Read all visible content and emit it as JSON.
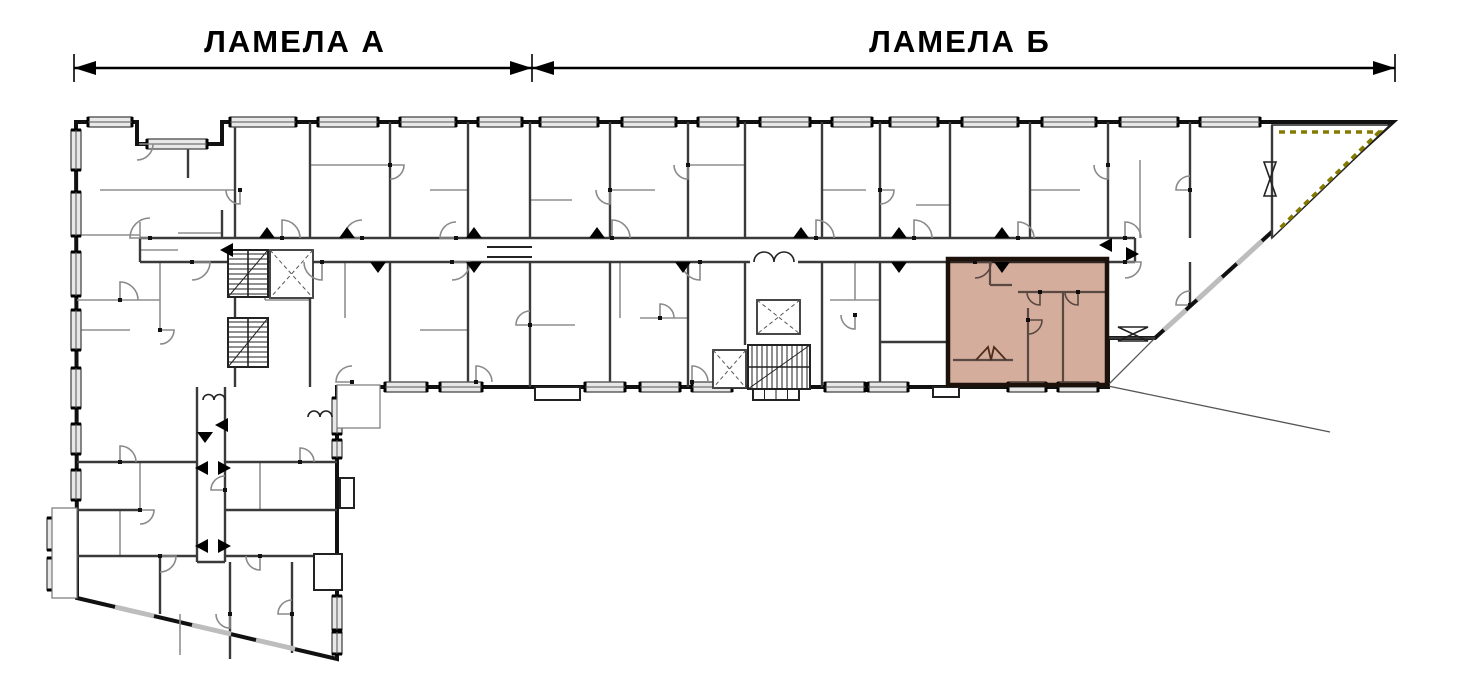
{
  "labels": {
    "lamela_a": "ЛАМЕЛА А",
    "lamela_b": "ЛАМЕЛА  Б"
  },
  "colors": {
    "outline": "#111111",
    "wall_medium": "#3a3a3a",
    "wall_thin": "#8f8f8f",
    "arc": "#8a8a8a",
    "window_fill": "#e8e8e8",
    "window_edge": "#555555",
    "highlight_fill": "#cohere",
    "highlight": "#b97a5e",
    "highlight_border": "#1c120b",
    "terrace_dash": "#857a00",
    "stair": "#222222",
    "canopy": "#555555",
    "apartment_wall": "#6b6b6b",
    "background": "#ffffff"
  },
  "dimension": {
    "y": 68,
    "tick_half": 14,
    "ticks": [
      74,
      532,
      1395
    ],
    "segments": [
      {
        "x1": 74,
        "x2": 532,
        "label_key": "lamela_a",
        "label_x": 295
      },
      {
        "x1": 532,
        "x2": 1395,
        "label_key": "lamela_b",
        "label_x": 960
      }
    ],
    "label_y": 52
  },
  "plan": {
    "outline": [
      [
        76,
        122
      ],
      [
        137,
        122
      ],
      [
        137,
        144
      ],
      [
        222,
        144
      ],
      [
        222,
        122
      ],
      [
        1393,
        122
      ],
      [
        1155,
        338
      ],
      [
        1108,
        338
      ],
      [
        1108,
        387
      ],
      [
        337,
        387
      ],
      [
        337,
        659
      ],
      [
        77,
        598
      ]
    ],
    "canopy_lines": [
      [
        1155,
        338,
        1108,
        385
      ],
      [
        1108,
        386,
        1330,
        432
      ]
    ],
    "corridor_walls": [
      [
        140,
        238,
        1135,
        238
      ],
      [
        140,
        262,
        750,
        262
      ],
      [
        798,
        262,
        1135,
        262
      ],
      [
        140,
        238,
        140,
        262
      ],
      [
        1135,
        238,
        1135,
        262
      ]
    ],
    "walls_medium": [
      [
        235,
        122,
        235,
        238
      ],
      [
        310,
        122,
        310,
        238
      ],
      [
        390,
        122,
        390,
        238
      ],
      [
        468,
        122,
        468,
        238
      ],
      [
        530,
        122,
        530,
        238
      ],
      [
        610,
        122,
        610,
        238
      ],
      [
        688,
        122,
        688,
        238
      ],
      [
        745,
        122,
        745,
        238
      ],
      [
        822,
        122,
        822,
        238
      ],
      [
        880,
        122,
        880,
        238
      ],
      [
        950,
        122,
        950,
        238
      ],
      [
        1030,
        122,
        1030,
        238
      ],
      [
        1108,
        122,
        1108,
        238
      ],
      [
        1190,
        122,
        1190,
        238
      ],
      [
        222,
        210,
        222,
        238
      ],
      [
        188,
        144,
        188,
        178
      ],
      [
        235,
        262,
        235,
        387
      ],
      [
        310,
        262,
        310,
        387
      ],
      [
        390,
        262,
        390,
        387
      ],
      [
        468,
        262,
        468,
        387
      ],
      [
        530,
        262,
        530,
        387
      ],
      [
        610,
        262,
        610,
        387
      ],
      [
        688,
        262,
        688,
        387
      ],
      [
        745,
        262,
        745,
        345
      ],
      [
        822,
        262,
        822,
        387
      ],
      [
        880,
        262,
        880,
        387
      ],
      [
        1190,
        262,
        1190,
        305
      ],
      [
        1108,
        338,
        1155,
        338
      ],
      [
        880,
        342,
        948,
        342
      ],
      [
        1272,
        125,
        1272,
        238
      ],
      [
        197,
        387,
        197,
        562
      ],
      [
        225,
        387,
        225,
        562
      ],
      [
        197,
        562,
        225,
        562
      ],
      [
        77,
        462,
        197,
        462
      ],
      [
        225,
        462,
        337,
        462
      ],
      [
        77,
        510,
        140,
        510
      ],
      [
        225,
        510,
        337,
        510
      ],
      [
        77,
        556,
        197,
        556
      ],
      [
        225,
        556,
        337,
        556
      ],
      [
        230,
        562,
        230,
        659
      ],
      [
        292,
        562,
        292,
        653
      ],
      [
        160,
        556,
        160,
        614
      ]
    ],
    "walls_thin": [
      [
        100,
        190,
        235,
        190
      ],
      [
        310,
        165,
        390,
        165
      ],
      [
        430,
        190,
        468,
        190
      ],
      [
        530,
        200,
        572,
        200
      ],
      [
        610,
        190,
        655,
        190
      ],
      [
        688,
        165,
        745,
        165
      ],
      [
        822,
        190,
        866,
        190
      ],
      [
        916,
        205,
        950,
        205
      ],
      [
        1030,
        190,
        1080,
        190
      ],
      [
        1140,
        160,
        1140,
        238
      ],
      [
        77,
        235,
        140,
        235
      ],
      [
        140,
        222,
        140,
        250
      ],
      [
        140,
        250,
        178,
        250
      ],
      [
        178,
        233,
        222,
        233
      ],
      [
        265,
        300,
        310,
        300
      ],
      [
        265,
        262,
        265,
        300
      ],
      [
        345,
        262,
        345,
        318
      ],
      [
        420,
        330,
        468,
        330
      ],
      [
        530,
        325,
        575,
        325
      ],
      [
        620,
        262,
        620,
        318
      ],
      [
        640,
        318,
        688,
        318
      ],
      [
        830,
        300,
        880,
        300
      ],
      [
        855,
        262,
        855,
        300
      ],
      [
        140,
        462,
        140,
        510
      ],
      [
        260,
        462,
        260,
        510
      ],
      [
        120,
        510,
        120,
        556
      ],
      [
        180,
        614,
        180,
        655
      ],
      [
        77,
        300,
        160,
        300
      ],
      [
        160,
        262,
        160,
        300
      ],
      [
        160,
        300,
        160,
        330
      ],
      [
        77,
        330,
        130,
        330
      ]
    ],
    "walls_apartment": [
      [
        1018,
        292,
        1105,
        292
      ],
      [
        1063,
        292,
        1063,
        383
      ],
      [
        1028,
        308,
        1028,
        383
      ],
      [
        990,
        262,
        990,
        285
      ],
      [
        990,
        285,
        1012,
        285
      ],
      [
        953,
        360,
        1013,
        360
      ]
    ],
    "windows": [
      [
        88,
        117,
        44,
        10
      ],
      [
        147,
        139,
        60,
        10
      ],
      [
        230,
        117,
        66,
        10
      ],
      [
        318,
        117,
        60,
        10
      ],
      [
        400,
        117,
        56,
        10
      ],
      [
        478,
        117,
        44,
        10
      ],
      [
        540,
        117,
        58,
        10
      ],
      [
        622,
        117,
        54,
        10
      ],
      [
        698,
        117,
        40,
        10
      ],
      [
        760,
        117,
        50,
        10
      ],
      [
        832,
        117,
        40,
        10
      ],
      [
        890,
        117,
        48,
        10
      ],
      [
        962,
        117,
        56,
        10
      ],
      [
        1042,
        117,
        54,
        10
      ],
      [
        1120,
        117,
        58,
        10
      ],
      [
        1200,
        117,
        60,
        10
      ],
      [
        71,
        130,
        10,
        40
      ],
      [
        71,
        192,
        10,
        44
      ],
      [
        71,
        252,
        10,
        44
      ],
      [
        71,
        310,
        10,
        40
      ],
      [
        71,
        368,
        10,
        40
      ],
      [
        71,
        424,
        10,
        30
      ],
      [
        71,
        470,
        10,
        30
      ],
      [
        47,
        518,
        10,
        32
      ],
      [
        47,
        558,
        10,
        32
      ],
      [
        385,
        382,
        42,
        10
      ],
      [
        440,
        382,
        42,
        10
      ],
      [
        585,
        382,
        40,
        10
      ],
      [
        640,
        382,
        40,
        10
      ],
      [
        692,
        382,
        40,
        10
      ],
      [
        825,
        382,
        40,
        10
      ],
      [
        868,
        382,
        40,
        10
      ],
      [
        1008,
        382,
        38,
        10
      ],
      [
        1058,
        382,
        40,
        10
      ],
      [
        332,
        398,
        10,
        36
      ],
      [
        332,
        440,
        10,
        18
      ],
      [
        332,
        596,
        10,
        34
      ],
      [
        332,
        632,
        10,
        22
      ]
    ],
    "window_dashes": [
      [
        1262,
        241,
        1237,
        264
      ],
      [
        1222,
        277,
        1197,
        300
      ],
      [
        1186,
        310,
        1164,
        330
      ],
      [
        115,
        607,
        154,
        616
      ],
      [
        192,
        625,
        231,
        634
      ],
      [
        256,
        640,
        295,
        649
      ]
    ],
    "porches": [
      {
        "x": 337,
        "y": 385,
        "w": 43,
        "h": 43,
        "thin": true
      },
      {
        "x": 535,
        "y": 387,
        "w": 45,
        "h": 13,
        "thin": false
      },
      {
        "x": 753,
        "y": 387,
        "w": 46,
        "h": 13,
        "thin": false,
        "steps": true
      },
      {
        "x": 933,
        "y": 387,
        "w": 26,
        "h": 10,
        "thin": false
      },
      {
        "x": 340,
        "y": 478,
        "w": 14,
        "h": 30,
        "thin": false
      },
      {
        "x": 314,
        "y": 554,
        "w": 28,
        "h": 36,
        "thin": false
      },
      {
        "x": 52,
        "y": 508,
        "w": 25,
        "h": 90,
        "thin": true
      }
    ],
    "stairs": [
      {
        "x": 748,
        "y": 345,
        "w": 62,
        "h": 44,
        "dir": "h"
      },
      {
        "x": 228,
        "y": 250,
        "w": 40,
        "h": 47,
        "dir": "v"
      },
      {
        "x": 228,
        "y": 318,
        "w": 40,
        "h": 49,
        "dir": "v"
      }
    ],
    "elevators": [
      {
        "x": 270,
        "y": 250,
        "w": 43,
        "h": 48
      },
      {
        "x": 713,
        "y": 350,
        "w": 33,
        "h": 38
      },
      {
        "x": 757,
        "y": 300,
        "w": 43,
        "h": 34
      }
    ],
    "arcs": [
      [
        150,
        238,
        20,
        180
      ],
      [
        282,
        238,
        18,
        270
      ],
      [
        362,
        238,
        18,
        180
      ],
      [
        456,
        238,
        16,
        180
      ],
      [
        612,
        238,
        18,
        270
      ],
      [
        816,
        238,
        18,
        270
      ],
      [
        914,
        238,
        18,
        270
      ],
      [
        1018,
        238,
        16,
        270
      ],
      [
        1125,
        238,
        16,
        270
      ],
      [
        137,
        144,
        16,
        0
      ],
      [
        240,
        190,
        14,
        90
      ],
      [
        390,
        165,
        14,
        0
      ],
      [
        610,
        190,
        14,
        90
      ],
      [
        688,
        165,
        14,
        90
      ],
      [
        880,
        190,
        14,
        0
      ],
      [
        1108,
        165,
        14,
        90
      ],
      [
        1190,
        190,
        14,
        180
      ],
      [
        192,
        262,
        18,
        0
      ],
      [
        322,
        262,
        18,
        90
      ],
      [
        452,
        262,
        18,
        0
      ],
      [
        700,
        262,
        18,
        90
      ],
      [
        1125,
        262,
        16,
        0
      ],
      [
        530,
        325,
        14,
        180
      ],
      [
        660,
        318,
        14,
        270
      ],
      [
        855,
        315,
        14,
        90
      ],
      [
        1190,
        305,
        14,
        180
      ],
      [
        352,
        382,
        16,
        180
      ],
      [
        476,
        382,
        16,
        270
      ],
      [
        692,
        382,
        16,
        270
      ],
      [
        120,
        462,
        16,
        270
      ],
      [
        225,
        490,
        14,
        180
      ],
      [
        160,
        556,
        16,
        0
      ],
      [
        260,
        556,
        14,
        90
      ],
      [
        120,
        300,
        18,
        270
      ],
      [
        160,
        330,
        14,
        0
      ],
      [
        300,
        462,
        14,
        270
      ],
      [
        230,
        614,
        14,
        90
      ],
      [
        292,
        614,
        14,
        180
      ],
      [
        140,
        510,
        14,
        0
      ]
    ],
    "arcs_apartment": [
      [
        975,
        262,
        16,
        0
      ],
      [
        1040,
        292,
        13,
        90
      ],
      [
        1078,
        292,
        13,
        90
      ],
      [
        1028,
        320,
        14,
        0
      ]
    ],
    "triangles": {
      "up": [
        267,
        347,
        474,
        597,
        801,
        899,
        1002
      ],
      "down": [
        [
          378,
          262
        ],
        [
          474,
          262
        ],
        [
          683,
          262
        ],
        [
          899,
          262
        ],
        [
          1002,
          262
        ],
        [
          205,
          432
        ]
      ],
      "left": [
        [
          233,
          250
        ],
        [
          1112,
          245
        ],
        [
          208,
          468
        ],
        [
          208,
          546
        ],
        [
          228,
          425
        ]
      ],
      "right": [
        [
          1126,
          254
        ],
        [
          218,
          468
        ],
        [
          218,
          546
        ]
      ]
    },
    "double_doors": [
      {
        "x1": 754,
        "x2": 794,
        "y": 262
      },
      {
        "x1": 203,
        "x2": 225,
        "y": 400
      },
      {
        "x1": 308,
        "x2": 332,
        "y": 417
      }
    ],
    "m_polyline": [
      [
        976,
        360
      ],
      [
        988,
        347
      ],
      [
        991,
        360
      ],
      [
        994,
        347
      ],
      [
        1006,
        360
      ]
    ],
    "bowties": [
      {
        "x1": 1118,
        "y1": 327,
        "x2": 1148,
        "y2": 341
      },
      {
        "x1": 1264,
        "y1": 162,
        "x2": 1276,
        "y2": 196
      }
    ],
    "joint_lines": [
      [
        487,
        247,
        532,
        247
      ],
      [
        487,
        257,
        532,
        257
      ]
    ],
    "terrace": {
      "poly": [
        [
          1272,
          125
        ],
        [
          1390,
          125
        ],
        [
          1272,
          238
        ]
      ],
      "dash": [
        [
          1279,
          132
        ],
        [
          1379,
          132
        ],
        [
          1279,
          229
        ]
      ]
    },
    "highlight": {
      "x": 948,
      "y": 259,
      "w": 159,
      "h": 126
    }
  }
}
